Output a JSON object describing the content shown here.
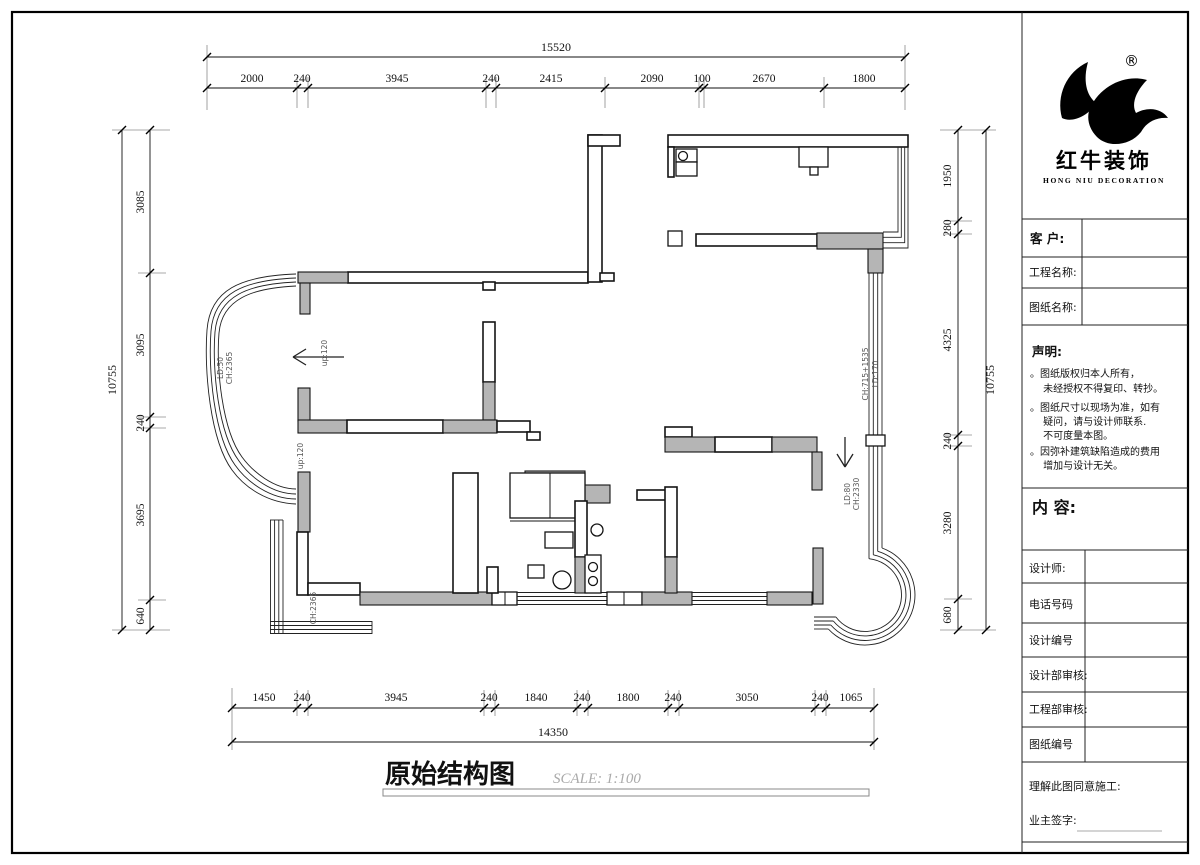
{
  "title_block": {
    "logo": {
      "registered": "®",
      "name_cn": "红牛装饰",
      "name_en": "HONG NIU DECORATION"
    },
    "fields": {
      "customer": "客  户:",
      "project": "工程名称:",
      "drawing": "图纸名称:"
    },
    "statement": {
      "title": "声明:",
      "lines": [
        "。图纸版权归本人所有，",
        "　 未经授权不得复印、转抄。",
        "。图纸尺寸以现场为准，如有",
        "　 疑问，请与设计师联系.",
        "　 不可度量本图。",
        "。因弥补建筑缺陷造成的费用",
        "　 增加与设计无关。"
      ]
    },
    "content_label": "内  容:",
    "rows": [
      "设计师:",
      "电话号码",
      "设计编号",
      "设计部审核:",
      "工程部审核:",
      "图纸编号"
    ],
    "agreement": "理解此图同意施工:",
    "owner_sign": "业主签字:"
  },
  "drawing_title": {
    "name": "原始结构图",
    "scale": "SCALE: 1:100"
  },
  "dims": {
    "top_total": "15520",
    "top": [
      "2000",
      "240",
      "3945",
      "240",
      "2415",
      "2090",
      "100",
      "2670",
      "1800"
    ],
    "bottom": [
      "1450",
      "240",
      "3945",
      "240",
      "1840",
      "240",
      "1800",
      "240",
      "3050",
      "240",
      "1065"
    ],
    "bottom_total": "14350",
    "left_total": "10755",
    "left": [
      "3085",
      "3095",
      "240",
      "3695",
      "640"
    ],
    "right": [
      "1950",
      "280",
      "4325",
      "240",
      "3280",
      "680"
    ],
    "right_total": "10755"
  },
  "annotations": {
    "up1": "up:120",
    "up2": "up:120",
    "win_left_ld": "LD:50",
    "win_left_ch": "CH:2365",
    "win_right_ld": "LD:170",
    "win_right_ch": "CH:715+1535",
    "bay_ld": "LD:80",
    "bay_ch": "CH:2330",
    "balcony_ch": "CH:2365"
  },
  "colors": {
    "wall_gray": "#b5b5b5",
    "line": "#141414",
    "dim_text": "#111111",
    "scale_text": "#aaaaaa"
  }
}
